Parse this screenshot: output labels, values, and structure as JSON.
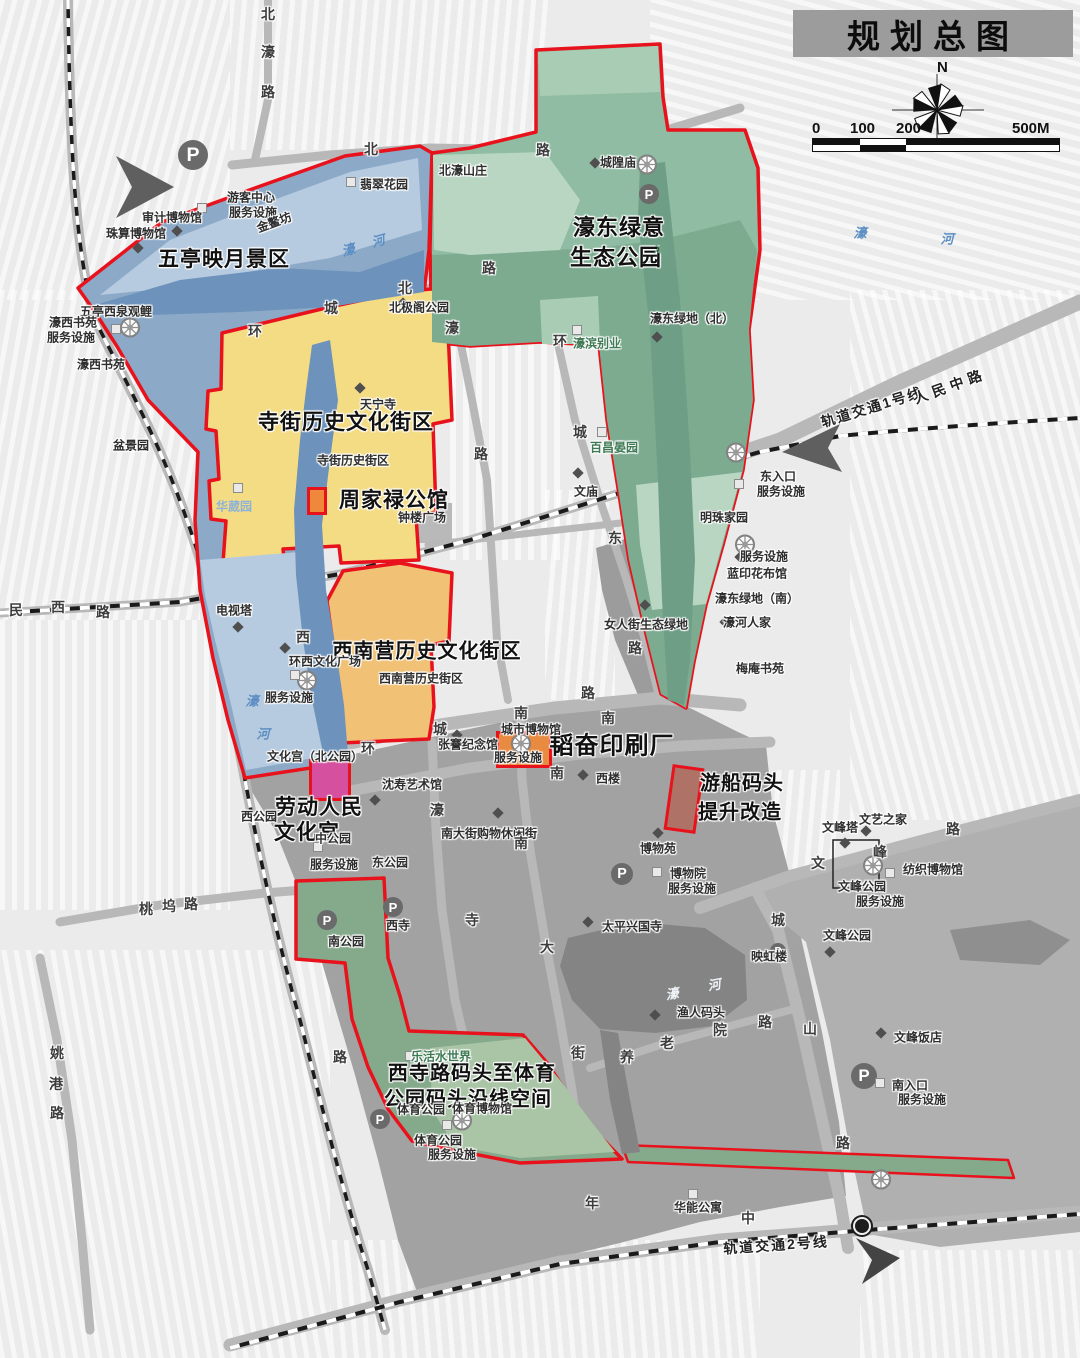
{
  "title": {
    "text": "规划总图"
  },
  "compass": {
    "north_label": "N"
  },
  "scale_bar": {
    "labels": [
      "0",
      "100",
      "200",
      "500M"
    ]
  },
  "colors": {
    "boundary_red": "#e8121c",
    "blue_region": "#8caac8",
    "water_blue": "#6d92bb",
    "green_region": "#8fbca2",
    "green_dark": "#7cab90",
    "yellow_region": "#f4dc85",
    "orange_region": "#f1c176",
    "south_green": "#85a98b",
    "urban_gray": "#a2a2a2",
    "road_gray": "#b8b8b8",
    "water_dark": "#848484",
    "title_bar": "#9c9c9c",
    "highlight_orange": "#e98a41",
    "highlight_pink": "#d5519f"
  },
  "regions": [
    {
      "id": "wuting",
      "name": "五亭映月景区",
      "color": "#8caac8"
    },
    {
      "id": "haodong",
      "name": "濠东绿意生态公园",
      "color": "#8fbca2"
    },
    {
      "id": "sijie",
      "name": "寺街历史文化街区",
      "color": "#f4dc85"
    },
    {
      "id": "xinanying",
      "name": "西南营历史文化街区",
      "color": "#f1c176"
    },
    {
      "id": "xisilu",
      "name": "西寺路码头至体育公园码头沿线空间",
      "color": "#85a98b"
    }
  ],
  "labels": [
    {
      "t": "五亭映月景区",
      "x": 224,
      "y": 258,
      "c": "big",
      "s": 21
    },
    {
      "t": "濠东绿意",
      "x": 619,
      "y": 226,
      "c": "big",
      "s": 22
    },
    {
      "t": "生态公园",
      "x": 616,
      "y": 256,
      "c": "big",
      "s": 22
    },
    {
      "t": "寺街历史文化街区",
      "x": 346,
      "y": 421,
      "c": "big",
      "s": 21
    },
    {
      "t": "周家禄公馆",
      "x": 394,
      "y": 499,
      "c": "big",
      "s": 21
    },
    {
      "t": "西南营历史文化街区",
      "x": 427,
      "y": 649,
      "c": "big",
      "s": 20
    },
    {
      "t": "劳动人民",
      "x": 319,
      "y": 806,
      "c": "big",
      "s": 21
    },
    {
      "t": "文化宫",
      "x": 307,
      "y": 831,
      "c": "big",
      "s": 21
    },
    {
      "t": "韬奋印刷厂",
      "x": 612,
      "y": 743,
      "c": "big",
      "s": 24
    },
    {
      "t": "游船码头",
      "x": 742,
      "y": 781,
      "c": "big",
      "s": 20
    },
    {
      "t": "提升改造",
      "x": 740,
      "y": 810,
      "c": "big",
      "s": 20
    },
    {
      "t": "西寺路码头至体育",
      "x": 472,
      "y": 1071,
      "c": "big",
      "s": 20
    },
    {
      "t": "公园码头沿线空间",
      "x": 468,
      "y": 1097,
      "c": "big",
      "s": 20
    },
    {
      "t": "寺街历史街区",
      "x": 353,
      "y": 460,
      "c": "med",
      "s": 12
    },
    {
      "t": "西南营历史街区",
      "x": 421,
      "y": 678,
      "c": "med",
      "s": 12
    },
    {
      "t": "审计博物馆",
      "x": 172,
      "y": 217,
      "c": "med",
      "s": 12
    },
    {
      "t": "游客中心",
      "x": 251,
      "y": 197,
      "c": "med",
      "s": 12
    },
    {
      "t": "服务设施",
      "x": 253,
      "y": 212,
      "c": "med",
      "s": 12
    },
    {
      "t": "珠算博物馆",
      "x": 136,
      "y": 233,
      "c": "med",
      "s": 12
    },
    {
      "t": "金鳌坊",
      "x": 274,
      "y": 222,
      "c": "med",
      "s": 12,
      "r": -20
    },
    {
      "t": "翡翠花园",
      "x": 384,
      "y": 184,
      "c": "med",
      "s": 12
    },
    {
      "t": "五亭西泉观鲤",
      "x": 116,
      "y": 311,
      "c": "med",
      "s": 12
    },
    {
      "t": "濠西书苑",
      "x": 73,
      "y": 322,
      "c": "med",
      "s": 12
    },
    {
      "t": "服务设施",
      "x": 71,
      "y": 337,
      "c": "med",
      "s": 12
    },
    {
      "t": "濠西书苑",
      "x": 101,
      "y": 364,
      "c": "med",
      "s": 12
    },
    {
      "t": "盆景园",
      "x": 131,
      "y": 445,
      "c": "med",
      "s": 12
    },
    {
      "t": "华葳园",
      "x": 234,
      "y": 506,
      "c": "blue",
      "s": 12
    },
    {
      "t": "北濠山庄",
      "x": 463,
      "y": 170,
      "c": "med",
      "s": 12
    },
    {
      "t": "城隍庙",
      "x": 618,
      "y": 162,
      "c": "med",
      "s": 12
    },
    {
      "t": "濠东绿地（北）",
      "x": 692,
      "y": 318,
      "c": "med",
      "s": 12
    },
    {
      "t": "濠滨别业",
      "x": 597,
      "y": 343,
      "c": "green",
      "s": 12
    },
    {
      "t": "百昌晏园",
      "x": 614,
      "y": 447,
      "c": "green",
      "s": 12
    },
    {
      "t": "明珠家园",
      "x": 724,
      "y": 517,
      "c": "med",
      "s": 12
    },
    {
      "t": "东入口",
      "x": 778,
      "y": 476,
      "c": "med",
      "s": 12
    },
    {
      "t": "服务设施",
      "x": 781,
      "y": 491,
      "c": "med",
      "s": 12
    },
    {
      "t": "服务设施",
      "x": 764,
      "y": 556,
      "c": "med",
      "s": 12
    },
    {
      "t": "蓝印花布馆",
      "x": 757,
      "y": 573,
      "c": "med",
      "s": 12
    },
    {
      "t": "濠东绿地（南）",
      "x": 757,
      "y": 598,
      "c": "med",
      "s": 12
    },
    {
      "t": "濠河人家",
      "x": 747,
      "y": 622,
      "c": "med",
      "s": 12
    },
    {
      "t": "梅庵书苑",
      "x": 760,
      "y": 668,
      "c": "med",
      "s": 12
    },
    {
      "t": "北极阁公园",
      "x": 419,
      "y": 307,
      "c": "med",
      "s": 12
    },
    {
      "t": "天宁寺",
      "x": 378,
      "y": 404,
      "c": "med",
      "s": 12
    },
    {
      "t": "文庙",
      "x": 586,
      "y": 491,
      "c": "med",
      "s": 12
    },
    {
      "t": "钟楼广场",
      "x": 422,
      "y": 517,
      "c": "med",
      "s": 12
    },
    {
      "t": "女人街生态绿地",
      "x": 646,
      "y": 624,
      "c": "med",
      "s": 12
    },
    {
      "t": "电视塔",
      "x": 234,
      "y": 610,
      "c": "med",
      "s": 12
    },
    {
      "t": "环西文化广场",
      "x": 325,
      "y": 661,
      "c": "med",
      "s": 12
    },
    {
      "t": "服务设施",
      "x": 289,
      "y": 697,
      "c": "med",
      "s": 12
    },
    {
      "t": "文化宫（北公园）",
      "x": 315,
      "y": 756,
      "c": "med",
      "s": 12
    },
    {
      "t": "沈寿艺术馆",
      "x": 412,
      "y": 784,
      "c": "med",
      "s": 12
    },
    {
      "t": "张謇纪念馆",
      "x": 468,
      "y": 744,
      "c": "med",
      "s": 12
    },
    {
      "t": "城市博物馆",
      "x": 531,
      "y": 729,
      "c": "med",
      "s": 12
    },
    {
      "t": "服务设施",
      "x": 518,
      "y": 757,
      "c": "med",
      "s": 12
    },
    {
      "t": "西楼",
      "x": 608,
      "y": 778,
      "c": "med",
      "s": 12
    },
    {
      "t": "西公园",
      "x": 259,
      "y": 816,
      "c": "med",
      "s": 12
    },
    {
      "t": "中公园",
      "x": 333,
      "y": 838,
      "c": "med",
      "s": 12
    },
    {
      "t": "服务设施",
      "x": 334,
      "y": 864,
      "c": "med",
      "s": 12
    },
    {
      "t": "东公园",
      "x": 390,
      "y": 862,
      "c": "med",
      "s": 12
    },
    {
      "t": "南公园",
      "x": 346,
      "y": 941,
      "c": "med",
      "s": 12
    },
    {
      "t": "西寺",
      "x": 398,
      "y": 925,
      "c": "med",
      "s": 12
    },
    {
      "t": "南大街购物休闲街",
      "x": 489,
      "y": 833,
      "c": "med",
      "s": 12
    },
    {
      "t": "博物苑",
      "x": 658,
      "y": 848,
      "c": "med",
      "s": 12
    },
    {
      "t": "博物院",
      "x": 688,
      "y": 873,
      "c": "med",
      "s": 12
    },
    {
      "t": "服务设施",
      "x": 692,
      "y": 888,
      "c": "med",
      "s": 12
    },
    {
      "t": "太平兴国寺",
      "x": 632,
      "y": 926,
      "c": "med",
      "s": 12
    },
    {
      "t": "文峰塔",
      "x": 840,
      "y": 827,
      "c": "med",
      "s": 12
    },
    {
      "t": "文艺之家",
      "x": 883,
      "y": 819,
      "c": "med",
      "s": 12
    },
    {
      "t": "纺织博物馆",
      "x": 933,
      "y": 869,
      "c": "med",
      "s": 12
    },
    {
      "t": "文峰公园",
      "x": 862,
      "y": 886,
      "c": "med",
      "s": 12
    },
    {
      "t": "服务设施",
      "x": 880,
      "y": 901,
      "c": "med",
      "s": 12
    },
    {
      "t": "文峰公园",
      "x": 847,
      "y": 935,
      "c": "med",
      "s": 12
    },
    {
      "t": "映虹楼",
      "x": 769,
      "y": 956,
      "c": "med",
      "s": 12
    },
    {
      "t": "渔人码头",
      "x": 701,
      "y": 1012,
      "c": "med",
      "s": 12
    },
    {
      "t": "文峰饭店",
      "x": 918,
      "y": 1037,
      "c": "med",
      "s": 12
    },
    {
      "t": "南入口",
      "x": 910,
      "y": 1085,
      "c": "med",
      "s": 12
    },
    {
      "t": "服务设施",
      "x": 922,
      "y": 1099,
      "c": "med",
      "s": 12
    },
    {
      "t": "华能公寓",
      "x": 698,
      "y": 1207,
      "c": "med",
      "s": 12
    },
    {
      "t": "乐活水世界",
      "x": 441,
      "y": 1056,
      "c": "green",
      "s": 12
    },
    {
      "t": "体育公园",
      "x": 421,
      "y": 1109,
      "c": "med",
      "s": 12
    },
    {
      "t": "体育博物馆",
      "x": 482,
      "y": 1108,
      "c": "med",
      "s": 12
    },
    {
      "t": "体育公园",
      "x": 438,
      "y": 1140,
      "c": "med",
      "s": 12
    },
    {
      "t": "服务设施",
      "x": 452,
      "y": 1154,
      "c": "med",
      "s": 12
    },
    {
      "t": "北",
      "x": 268,
      "y": 14,
      "c": "road",
      "s": 14
    },
    {
      "t": "濠",
      "x": 268,
      "y": 52,
      "c": "road",
      "s": 14
    },
    {
      "t": "路",
      "x": 268,
      "y": 92,
      "c": "road",
      "s": 14
    },
    {
      "t": "北",
      "x": 371,
      "y": 149,
      "c": "road",
      "s": 14
    },
    {
      "t": "路",
      "x": 543,
      "y": 150,
      "c": "road",
      "s": 14
    },
    {
      "t": "环",
      "x": 255,
      "y": 331,
      "c": "road",
      "s": 14
    },
    {
      "t": "城",
      "x": 331,
      "y": 308,
      "c": "road",
      "s": 14
    },
    {
      "t": "北",
      "x": 405,
      "y": 288,
      "c": "road",
      "s": 14
    },
    {
      "t": "路",
      "x": 489,
      "y": 268,
      "c": "road",
      "s": 14
    },
    {
      "t": "濠",
      "x": 452,
      "y": 328,
      "c": "road",
      "s": 14
    },
    {
      "t": "路",
      "x": 481,
      "y": 454,
      "c": "road",
      "s": 14
    },
    {
      "t": "环",
      "x": 560,
      "y": 341,
      "c": "road",
      "s": 14
    },
    {
      "t": "城",
      "x": 580,
      "y": 432,
      "c": "road",
      "s": 14
    },
    {
      "t": "东",
      "x": 615,
      "y": 538,
      "c": "road",
      "s": 14
    },
    {
      "t": "路",
      "x": 635,
      "y": 648,
      "c": "road",
      "s": 14
    },
    {
      "t": "西",
      "x": 303,
      "y": 637,
      "c": "road",
      "s": 14
    },
    {
      "t": "环",
      "x": 368,
      "y": 748,
      "c": "road",
      "s": 14
    },
    {
      "t": "城",
      "x": 440,
      "y": 729,
      "c": "road",
      "s": 14
    },
    {
      "t": "南",
      "x": 521,
      "y": 713,
      "c": "road",
      "s": 14
    },
    {
      "t": "路",
      "x": 588,
      "y": 693,
      "c": "road",
      "s": 14
    },
    {
      "t": "南",
      "x": 608,
      "y": 718,
      "c": "road",
      "s": 14
    },
    {
      "t": "南",
      "x": 557,
      "y": 773,
      "c": "road",
      "s": 14
    },
    {
      "t": "濠",
      "x": 437,
      "y": 810,
      "c": "road",
      "s": 14
    },
    {
      "t": "南",
      "x": 521,
      "y": 843,
      "c": "road",
      "s": 14
    },
    {
      "t": "大",
      "x": 547,
      "y": 947,
      "c": "road",
      "s": 14
    },
    {
      "t": "街",
      "x": 578,
      "y": 1053,
      "c": "road",
      "s": 14
    },
    {
      "t": "寺",
      "x": 472,
      "y": 920,
      "c": "road",
      "s": 14
    },
    {
      "t": "路",
      "x": 340,
      "y": 1057,
      "c": "road",
      "s": 14
    },
    {
      "t": "城",
      "x": 778,
      "y": 920,
      "c": "road",
      "s": 14
    },
    {
      "t": "山",
      "x": 810,
      "y": 1029,
      "c": "road",
      "s": 14
    },
    {
      "t": "路",
      "x": 843,
      "y": 1143,
      "c": "road",
      "s": 14
    },
    {
      "t": "文",
      "x": 818,
      "y": 863,
      "c": "road",
      "s": 14
    },
    {
      "t": "峰",
      "x": 880,
      "y": 852,
      "c": "road",
      "s": 14
    },
    {
      "t": "路",
      "x": 953,
      "y": 829,
      "c": "road",
      "s": 14
    },
    {
      "t": "养",
      "x": 627,
      "y": 1057,
      "c": "road",
      "s": 14
    },
    {
      "t": "老",
      "x": 667,
      "y": 1043,
      "c": "road",
      "s": 14
    },
    {
      "t": "院",
      "x": 720,
      "y": 1030,
      "c": "road",
      "s": 14
    },
    {
      "t": "路",
      "x": 765,
      "y": 1022,
      "c": "road",
      "s": 14
    },
    {
      "t": "年",
      "x": 592,
      "y": 1203,
      "c": "road",
      "s": 14
    },
    {
      "t": "中",
      "x": 748,
      "y": 1218,
      "c": "road",
      "s": 14
    },
    {
      "t": "桃",
      "x": 146,
      "y": 909,
      "c": "road",
      "s": 14
    },
    {
      "t": "坞",
      "x": 169,
      "y": 906,
      "c": "road",
      "s": 14
    },
    {
      "t": "路",
      "x": 191,
      "y": 904,
      "c": "road",
      "s": 14
    },
    {
      "t": "姚",
      "x": 57,
      "y": 1053,
      "c": "road",
      "s": 14
    },
    {
      "t": "港",
      "x": 56,
      "y": 1084,
      "c": "road",
      "s": 14
    },
    {
      "t": "路",
      "x": 57,
      "y": 1113,
      "c": "road",
      "s": 14
    },
    {
      "t": "民",
      "x": 16,
      "y": 610,
      "c": "road",
      "s": 14
    },
    {
      "t": "西",
      "x": 58,
      "y": 607,
      "c": "road",
      "s": 14
    },
    {
      "t": "路",
      "x": 103,
      "y": 612,
      "c": "road",
      "s": 14
    },
    {
      "t": "轨道交通1号线",
      "x": 872,
      "y": 407,
      "c": "rail",
      "s": 14,
      "r": -17,
      "ls": 2
    },
    {
      "t": "人民中路",
      "x": 950,
      "y": 386,
      "c": "rail",
      "s": 14,
      "r": -20,
      "ls": 5
    },
    {
      "t": "轨道交通2号线",
      "x": 776,
      "y": 1245,
      "c": "rail",
      "s": 14,
      "r": -4,
      "ls": 2
    },
    {
      "t": "濠",
      "x": 348,
      "y": 249,
      "c": "water",
      "s": 13,
      "r": -15
    },
    {
      "t": "河",
      "x": 378,
      "y": 240,
      "c": "water",
      "s": 13,
      "r": -15
    },
    {
      "t": "濠",
      "x": 860,
      "y": 232,
      "c": "water",
      "s": 13
    },
    {
      "t": "河",
      "x": 947,
      "y": 238,
      "c": "water",
      "s": 13
    },
    {
      "t": "濠",
      "x": 252,
      "y": 700,
      "c": "water",
      "s": 13
    },
    {
      "t": "河",
      "x": 263,
      "y": 733,
      "c": "water",
      "s": 13
    },
    {
      "t": "濠",
      "x": 660,
      "y": 247,
      "c": "waterg",
      "s": 13
    },
    {
      "t": "濠",
      "x": 672,
      "y": 993,
      "c": "waterw",
      "s": 13,
      "r": -10
    },
    {
      "t": "河",
      "x": 714,
      "y": 984,
      "c": "waterw",
      "s": 13,
      "r": -10
    }
  ],
  "markers": {
    "p_label": "P",
    "p": [
      [
        193,
        155,
        15
      ],
      [
        649,
        194,
        10
      ],
      [
        622,
        874,
        11
      ],
      [
        393,
        907,
        10
      ],
      [
        327,
        920,
        10
      ],
      [
        380,
        1119,
        10
      ],
      [
        864,
        1076,
        13
      ],
      [
        778,
        951,
        8
      ]
    ],
    "station": [
      862,
      1226
    ],
    "wheels": [
      [
        647,
        167
      ],
      [
        130,
        330
      ],
      [
        307,
        683
      ],
      [
        521,
        746
      ],
      [
        736,
        455
      ],
      [
        745,
        547
      ],
      [
        462,
        1123
      ],
      [
        881,
        1182
      ],
      [
        873,
        868
      ]
    ],
    "diamonds": [
      [
        177,
        231
      ],
      [
        270,
        211
      ],
      [
        138,
        248
      ],
      [
        595,
        163
      ],
      [
        657,
        337
      ],
      [
        403,
        303
      ],
      [
        360,
        388
      ],
      [
        578,
        473
      ],
      [
        645,
        605
      ],
      [
        238,
        627
      ],
      [
        285,
        648
      ],
      [
        457,
        735
      ],
      [
        375,
        800
      ],
      [
        583,
        775
      ],
      [
        498,
        813
      ],
      [
        588,
        922
      ],
      [
        658,
        833
      ],
      [
        845,
        843
      ],
      [
        866,
        831
      ],
      [
        655,
        1015
      ],
      [
        830,
        952
      ],
      [
        881,
        1033
      ],
      [
        737,
        598
      ],
      [
        725,
        622
      ],
      [
        750,
        668
      ],
      [
        740,
        557
      ]
    ],
    "squares": [
      [
        351,
        182
      ],
      [
        445,
        169
      ],
      [
        202,
        208
      ],
      [
        116,
        329
      ],
      [
        602,
        432
      ],
      [
        577,
        330
      ],
      [
        712,
        515
      ],
      [
        739,
        484
      ],
      [
        890,
        873
      ],
      [
        693,
        1194
      ],
      [
        880,
        1083
      ],
      [
        458,
        1107
      ],
      [
        410,
        1056
      ],
      [
        447,
        1125
      ],
      [
        318,
        847
      ],
      [
        657,
        872
      ],
      [
        238,
        488
      ],
      [
        295,
        675
      ]
    ]
  },
  "highlight_boxes": [
    {
      "name": "zhoujialu-mansion-box",
      "x": 307,
      "y": 487,
      "w": 14,
      "h": 22,
      "rot": 0,
      "fill": "#f0883c"
    },
    {
      "name": "shenshou-art-box",
      "x": 309,
      "y": 759,
      "w": 36,
      "h": 36,
      "rot": 0,
      "fill": "#d5519f"
    },
    {
      "name": "taofen-print-box",
      "x": 496,
      "y": 731,
      "w": 50,
      "h": 31,
      "rot": 0,
      "fill": "#e98a41"
    },
    {
      "name": "boat-pier-box",
      "x": 668,
      "y": 766,
      "w": 26,
      "h": 60,
      "rot": 8,
      "fill": "rgba(186,74,52,0.55)"
    }
  ]
}
